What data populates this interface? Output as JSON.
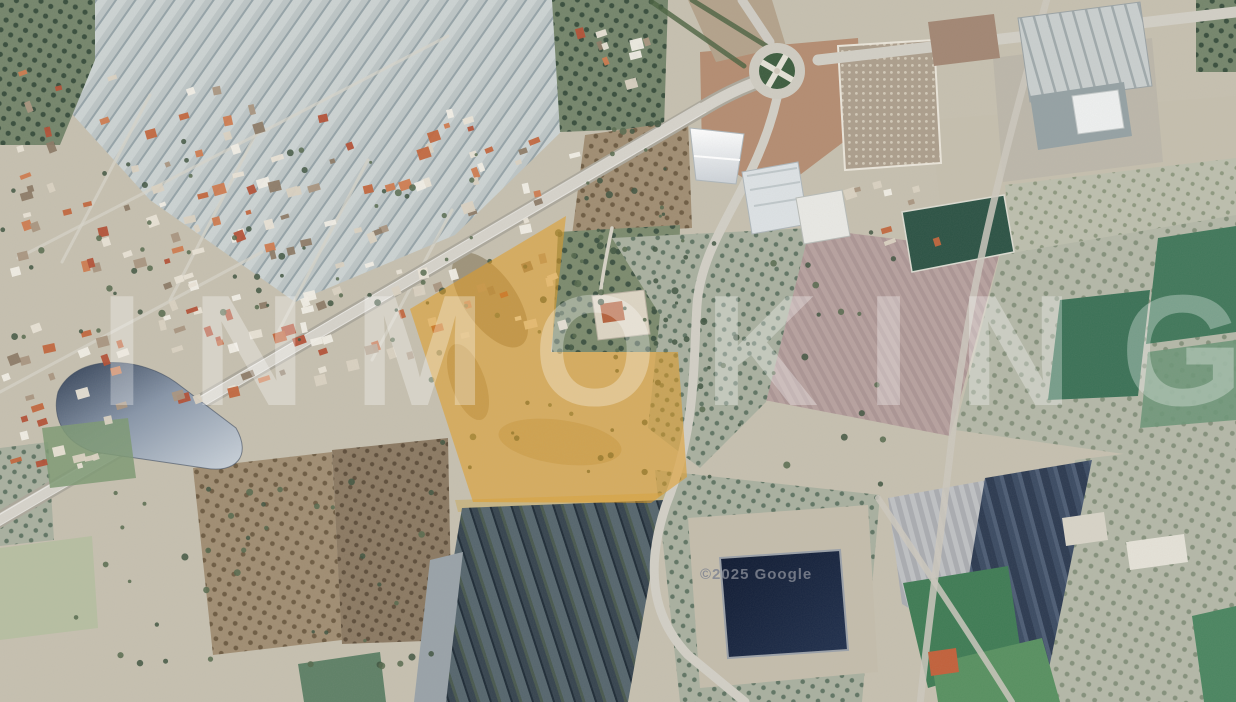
{
  "watermark": {
    "text": "INMOKING"
  },
  "attribution": {
    "text": "©2025 Google"
  },
  "map": {
    "view": "satellite",
    "highlight": {
      "label": "highlighted-parcel",
      "fill": "#E39B1E",
      "opacity": "0.55",
      "points": "566,216 551,352 678,352 687,477 651,503 473,502 410,309"
    }
  }
}
